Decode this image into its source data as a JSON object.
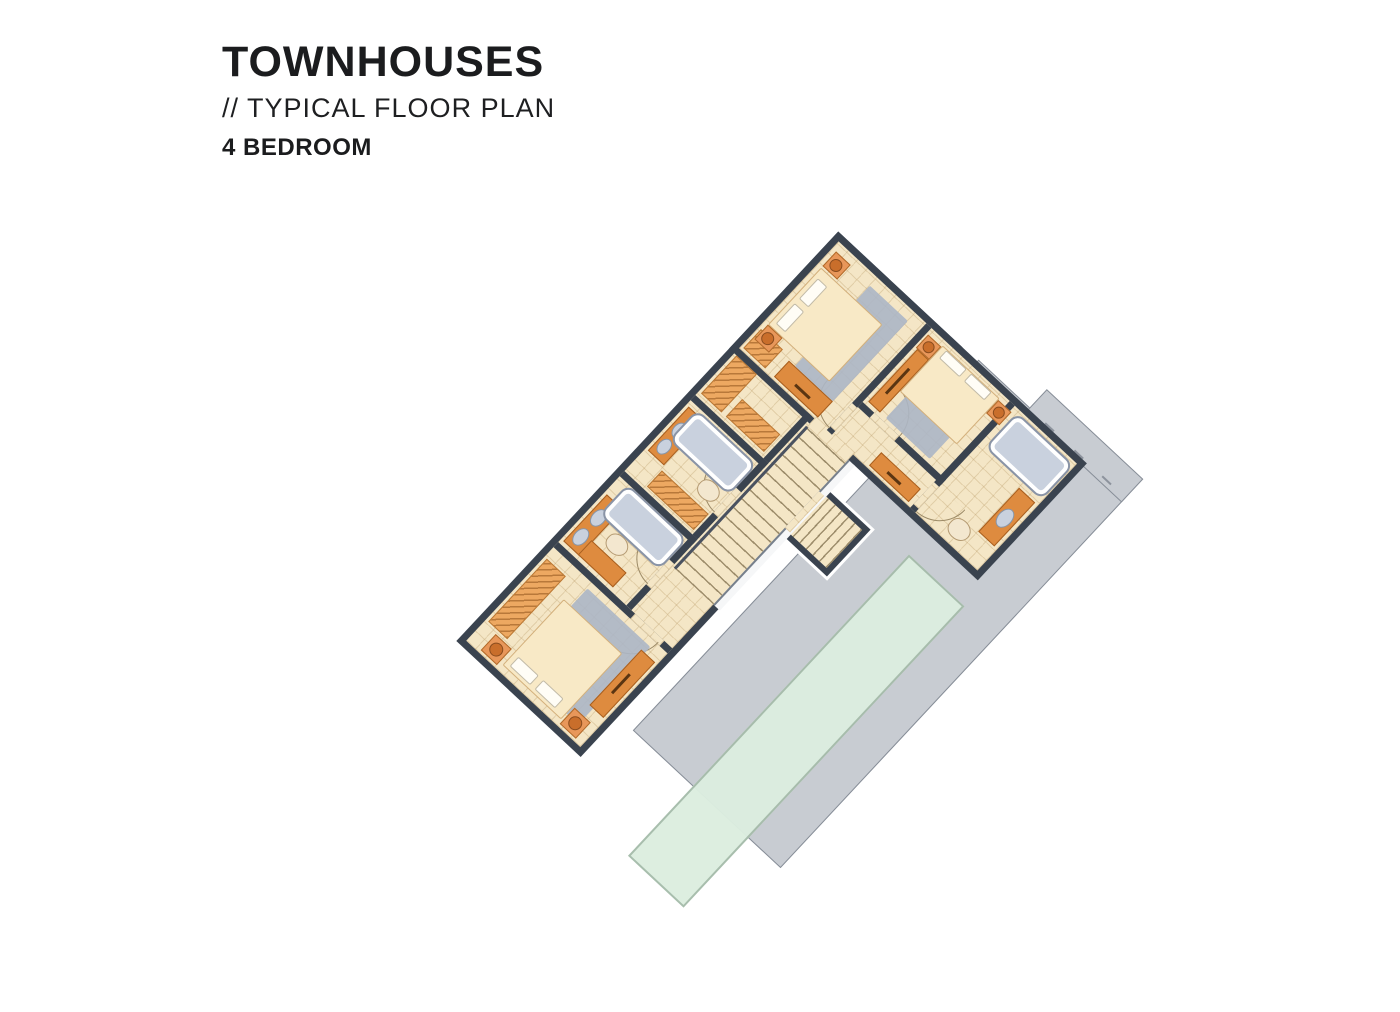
{
  "header": {
    "title": "TOWNHOUSES",
    "subtitle": "// TYPICAL FLOOR PLAN",
    "unit_type": "4 BEDROOM"
  },
  "colors": {
    "background": "#FFFFFF",
    "text_dark": "#1B1C1E",
    "wall": "#3A434F",
    "floor": "#F4E6C6",
    "tile_line": "rgba(187,156,106,0.33)",
    "counter_orange": "#DE8B3F",
    "wardrobe_orange": "#EDA861",
    "bed_cream": "#F8E9C6",
    "pillow_white": "#FFFDF6",
    "rug_gray": "#ACB6C5",
    "fixture_blue": "#C9D1DE",
    "fixture_rim": "#8A94A6",
    "lamp_orange": "#C96E2B",
    "roof_gray": "#C8CCD2",
    "skylight_green": "#DCEEE0",
    "skylight_border": "#A6BCAB",
    "arc_line": "#9C8A66",
    "stair_line": "rgba(122,104,70,0.7)",
    "railing": "#4A5260"
  }
}
